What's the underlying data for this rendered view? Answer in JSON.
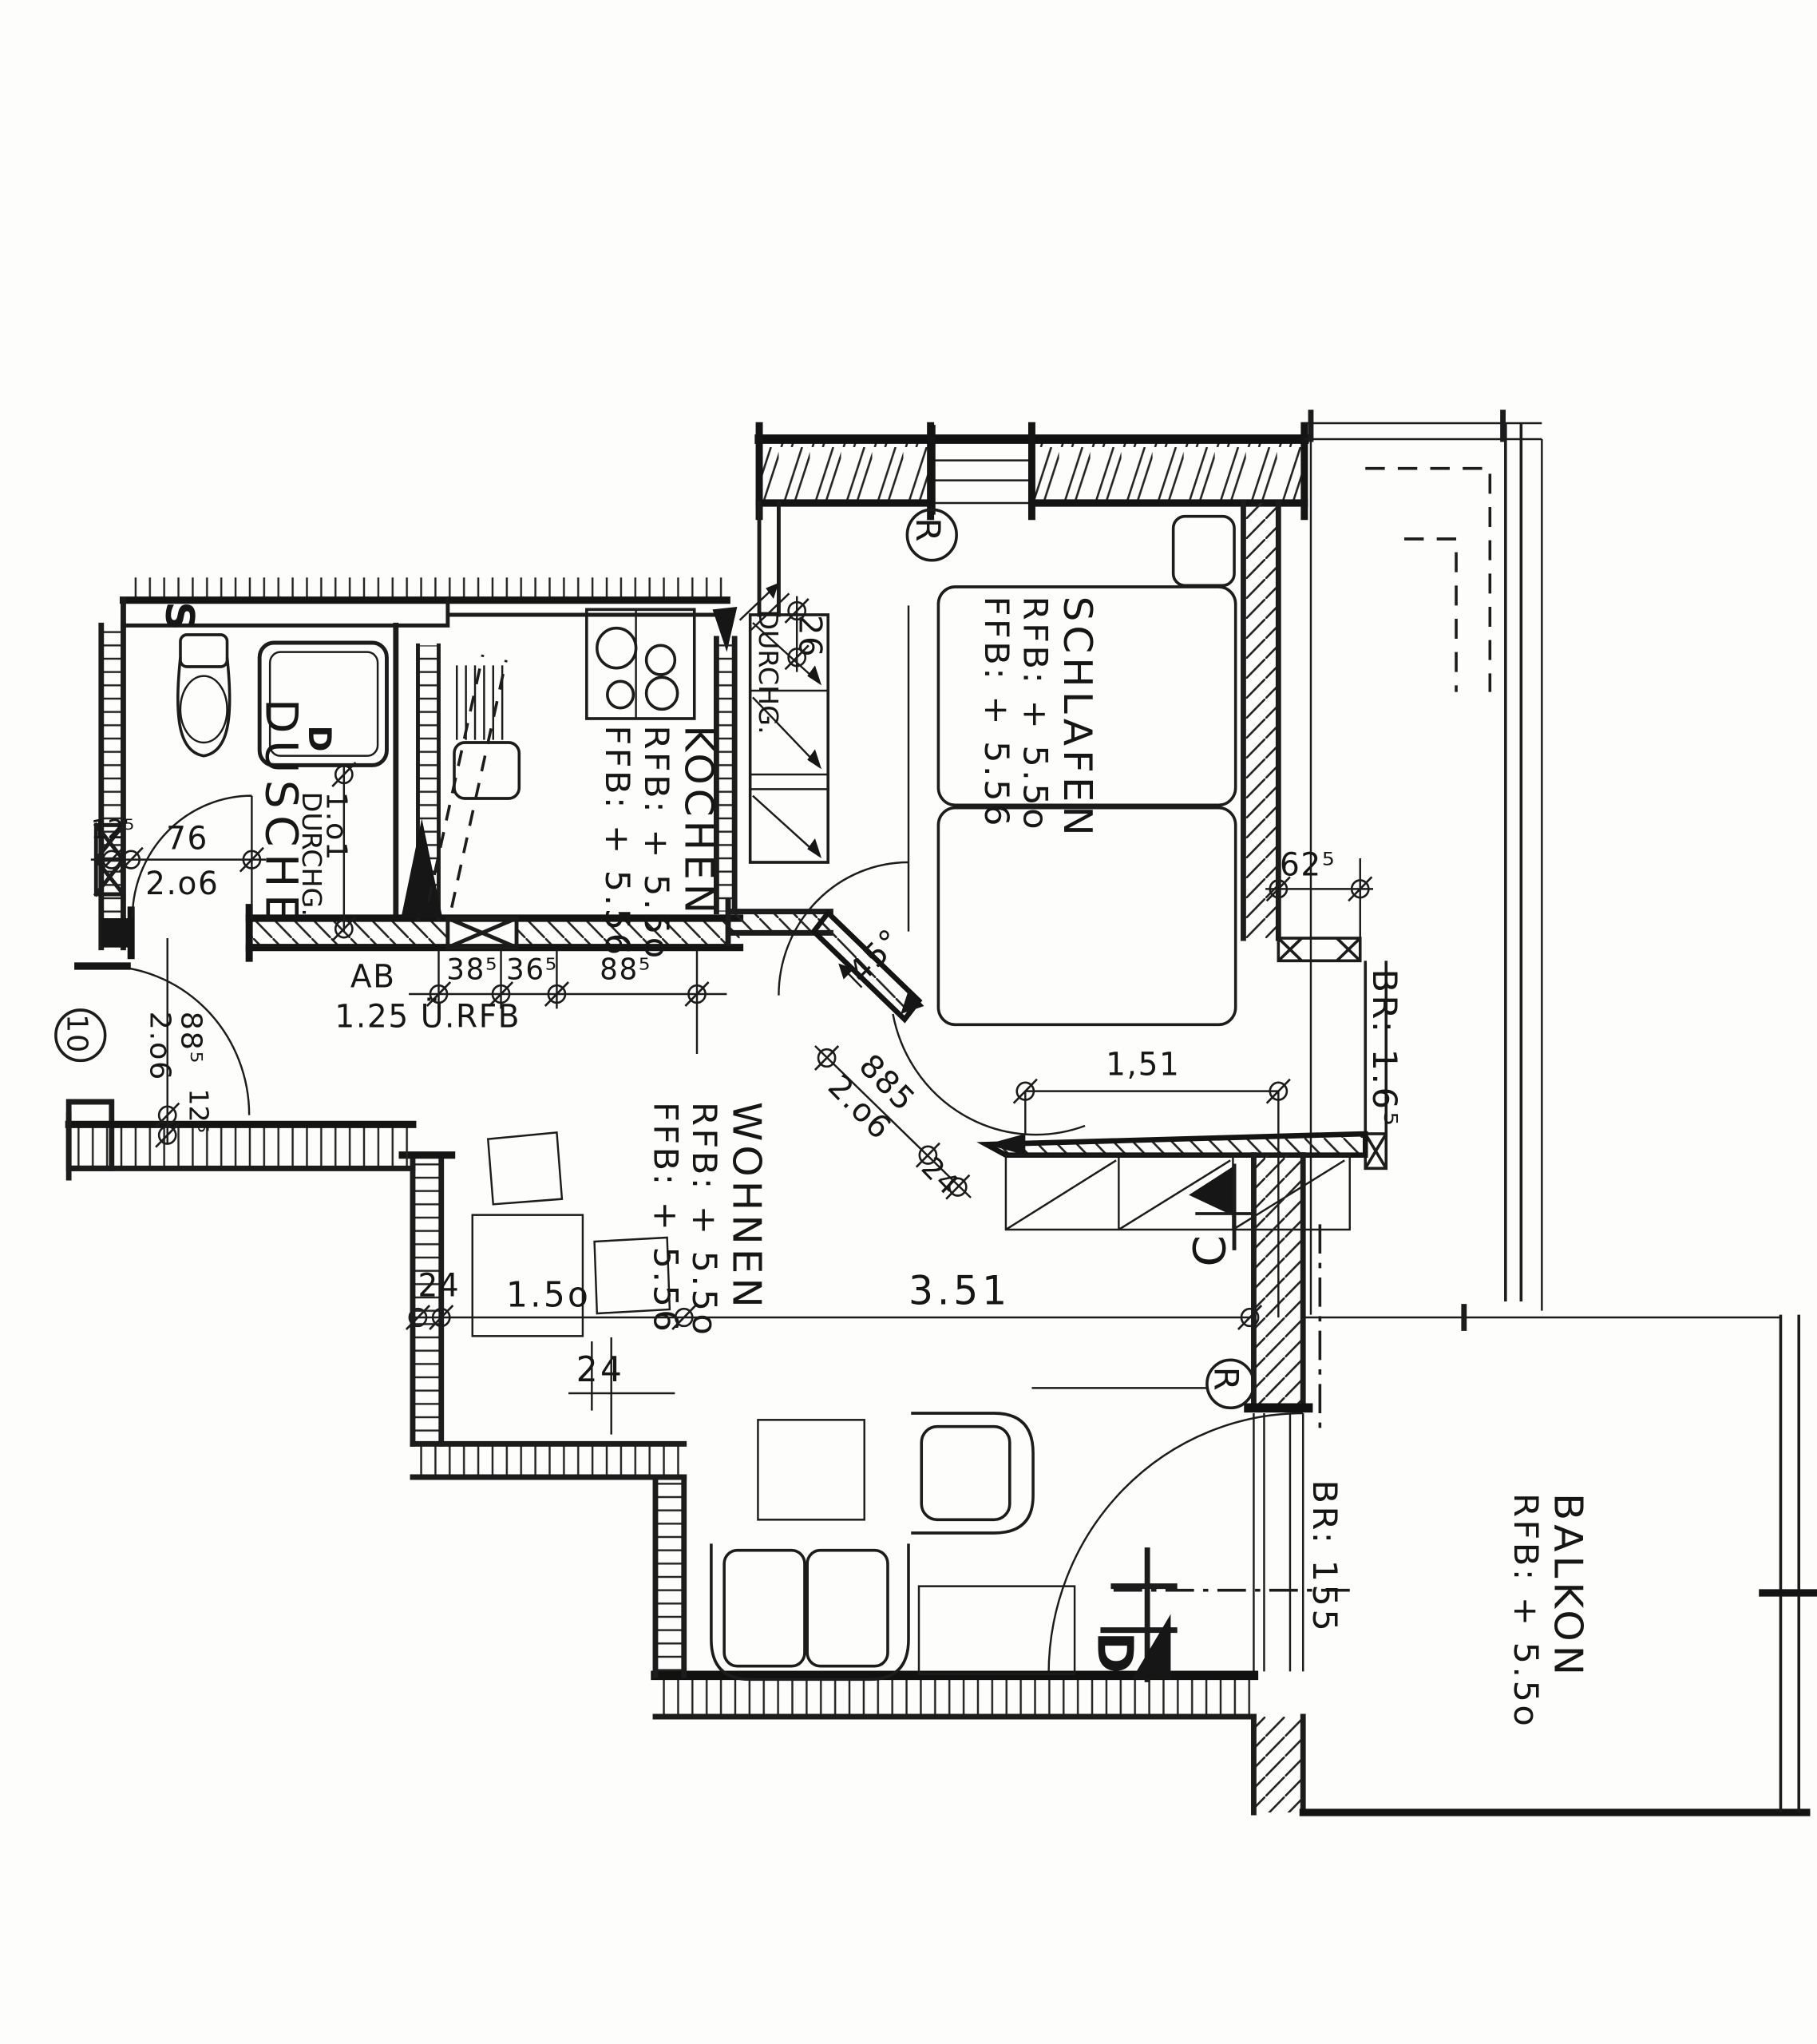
{
  "rooms": {
    "dusche": {
      "name": "DUSCHE"
    },
    "kochen": {
      "name": "KOCHEN",
      "rfb": "RFB: + 5.5o",
      "ffb": "FFB: + 5.56"
    },
    "schlafen": {
      "name": "SCHLAFEN",
      "rfb": "RFB: + 5.5o",
      "ffb": "FFB: + 5.56"
    },
    "wohnen": {
      "name": "WOHNEN",
      "rfb": "RFB: + 5.5o",
      "ffb": "FFB: + 5.56"
    },
    "balkon": {
      "name": "BALKON",
      "rfb": "RFB: + 5.5o"
    }
  },
  "markers": {
    "revision_top": "R",
    "revision_right": "R",
    "section_c": "C",
    "section_d": "D",
    "axis_circle": "10",
    "s_symbol": "S",
    "drain": "D"
  },
  "dims": {
    "bath_wall": "12⁵",
    "bath_door_w": "76",
    "bath_door_h": "2.o6",
    "bath_pass_w": "1.o1",
    "bath_pass_label": "DURCHG.",
    "kitchen_pass_label": "DURCHG.",
    "kitchen_pass_w": "26",
    "ab_label": "AB",
    "ab_height": "1.25 Ü.RFB",
    "seg_385": "38⁵",
    "seg_365": "36⁵",
    "seg_885": "88⁵",
    "entry_door_w": "88⁵",
    "entry_door_h": "2.o6",
    "entry_wall": "12⁵",
    "win_625": "62⁵",
    "win_br165": "BR: 1.6⁵",
    "win_151": "1,51",
    "diag_w": "885",
    "diag_h": "2.o6",
    "diag_24": "24",
    "diag_angle": "45°",
    "wall_24": "24",
    "dim_150": "1.5o",
    "dim_351": "3.51",
    "post_24": "24",
    "door_br155": "BR: 155"
  }
}
